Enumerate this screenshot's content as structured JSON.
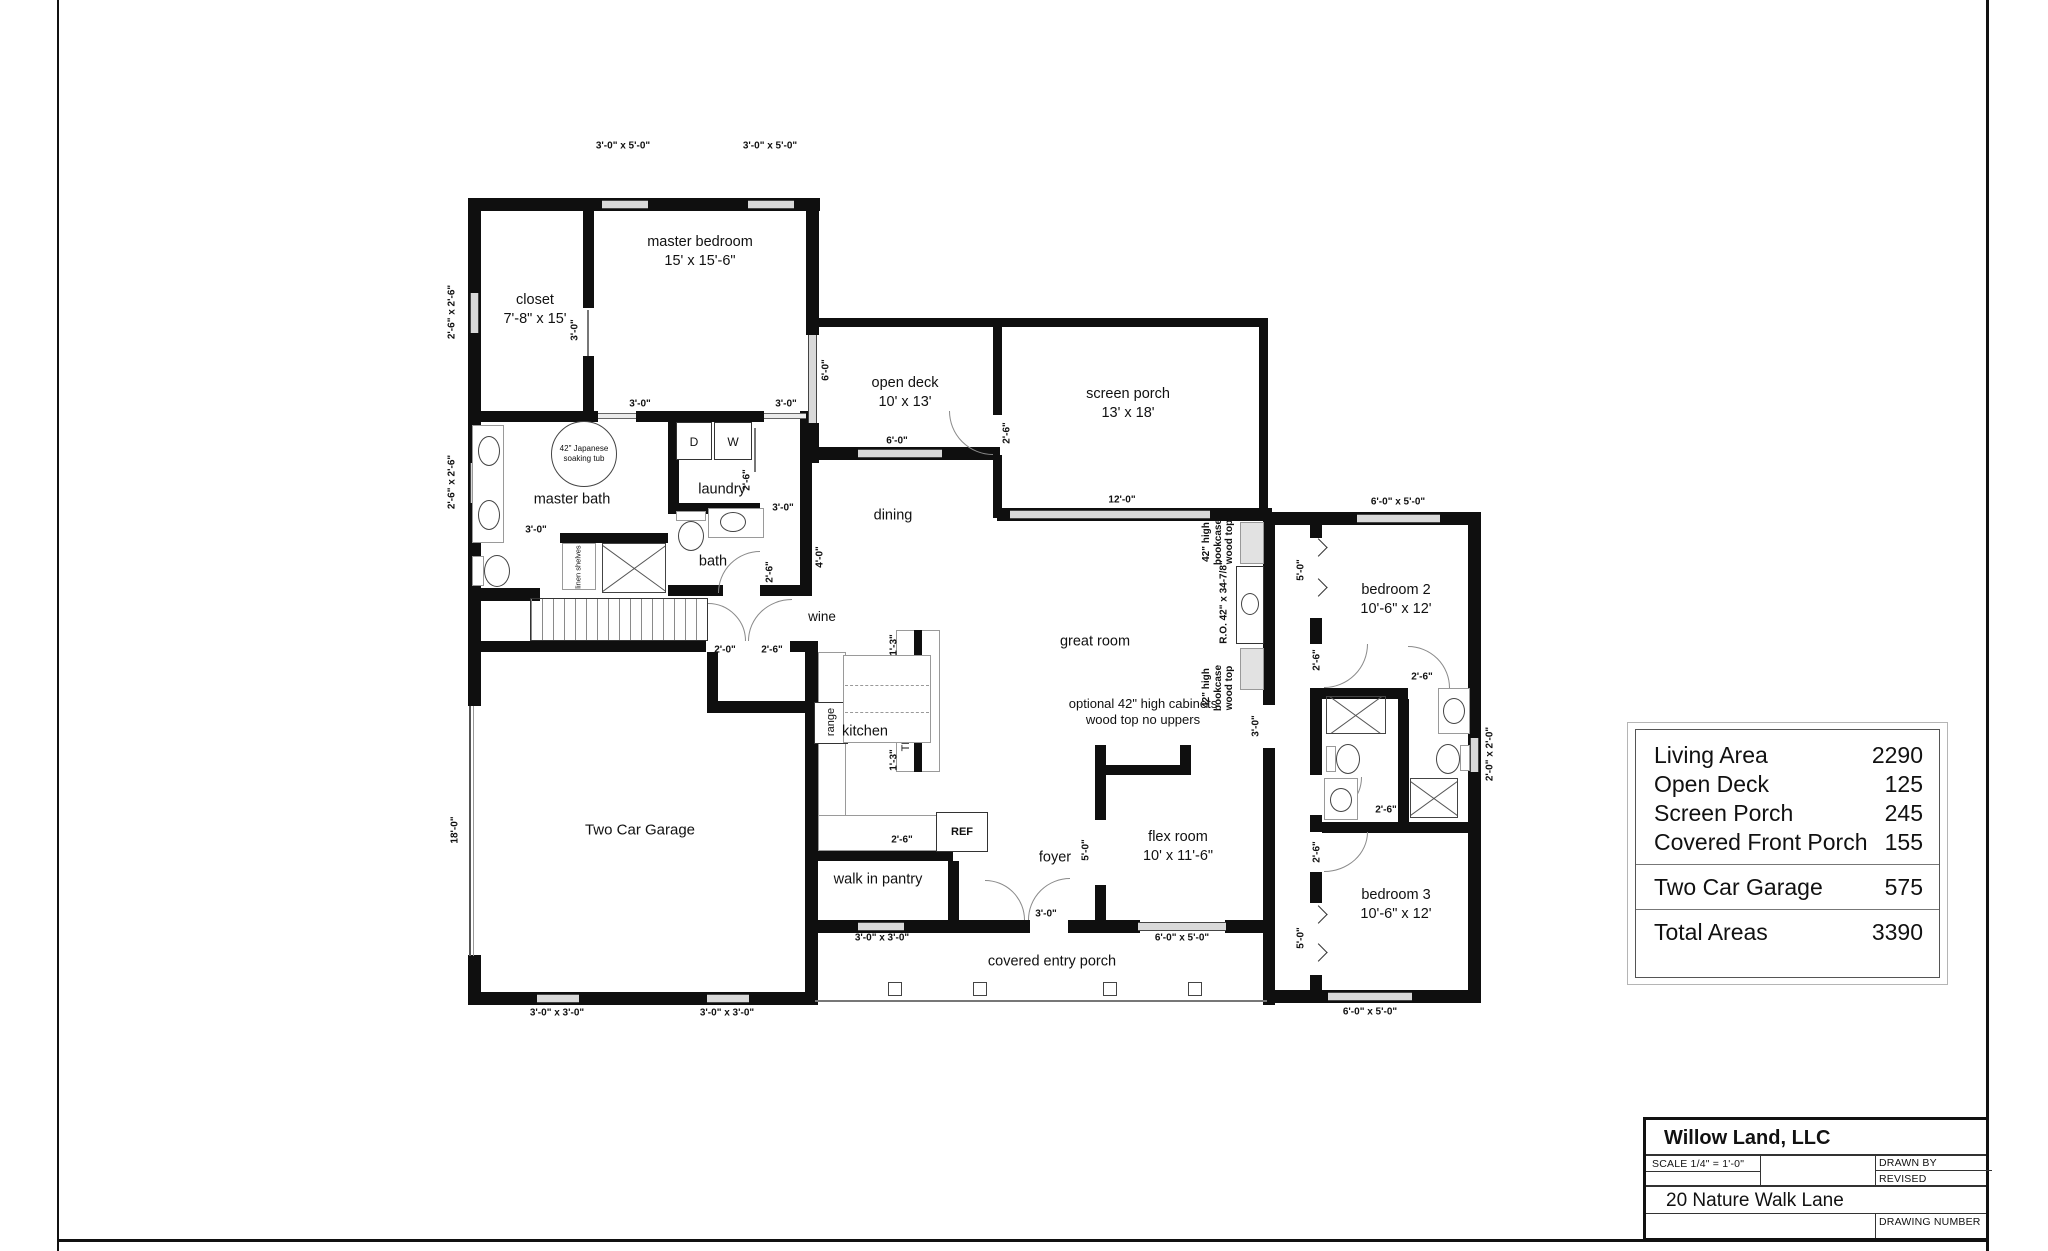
{
  "rooms": {
    "closet": {
      "name": "closet",
      "size": "7'-8\" x 15'"
    },
    "master_bedroom": {
      "name": "master bedroom",
      "size": "15' x 15'-6\""
    },
    "master_bath": {
      "name": "master bath"
    },
    "laundry": {
      "name": "laundry"
    },
    "bath": {
      "name": "bath"
    },
    "dining": {
      "name": "dining"
    },
    "open_deck": {
      "name": "open deck",
      "size": "10' x 13'"
    },
    "screen_porch": {
      "name": "screen porch",
      "size": "13' x 18'"
    },
    "great_room": {
      "name": "great room"
    },
    "kitchen": {
      "name": "kitchen"
    },
    "wine": {
      "name": "wine"
    },
    "walk_in_pantry": {
      "name": "walk in pantry"
    },
    "foyer": {
      "name": "foyer"
    },
    "flex_room": {
      "name": "flex room",
      "size": "10' x 11'-6\""
    },
    "bedroom_2": {
      "name": "bedroom 2",
      "size": "10'-6\" x 12'"
    },
    "bedroom_3": {
      "name": "bedroom 3",
      "size": "10'-6\" x 12'"
    },
    "garage": {
      "name": "Two Car Garage"
    },
    "covered_entry_porch": {
      "name": "covered entry porch"
    }
  },
  "fixtures": {
    "dryer": "D",
    "washer": "W",
    "fridge": "REF",
    "trash": "TR",
    "dishwasher": "dw",
    "range": "range",
    "linen": "linen shelves",
    "tub": "42\" Japanese soaking tub",
    "bookcase": "42\" high bookcase wood top",
    "bookcase_ro": "R.O. 42\" x 34-7/8\"",
    "optional_cabinets": "optional 42\" high cabinets wood top no uppers"
  },
  "dims": {
    "w30x50": "3'-0\" x 5'-0\"",
    "w26x26": "2'-6\" x 2'-6\"",
    "w30x30": "3'-0\" x 3'-0\"",
    "w60x50": "6'-0\" x 5'-0\"",
    "w20x20": "2'-0\" x 2'-0\"",
    "d30": "3'-0\"",
    "d26": "2'-6\"",
    "d20": "2'-0\"",
    "d60": "6'-0\"",
    "d40": "4'-0\"",
    "d50": "5'-0\"",
    "d120": "12'-0\"",
    "d13": "1'-3\"",
    "d180": "18'-0\""
  },
  "area_table": {
    "living": {
      "label": "Living Area",
      "value": "2290"
    },
    "open_deck": {
      "label": "Open Deck",
      "value": "125"
    },
    "screen_porch": {
      "label": "Screen Porch",
      "value": "245"
    },
    "covered_front_porch": {
      "label": "Covered Front Porch",
      "value": "155"
    },
    "garage": {
      "label": "Two Car Garage",
      "value": "575"
    },
    "total": {
      "label": "Total Areas",
      "value": "3390"
    }
  },
  "title_block": {
    "company": "Willow Land, LLC",
    "scale": "SCALE 1/4\" = 1'-0\"",
    "drawn_by": "DRAWN BY",
    "revised": "REVISED",
    "address": "20 Nature Walk Lane",
    "drawing_number": "DRAWING NUMBER"
  }
}
